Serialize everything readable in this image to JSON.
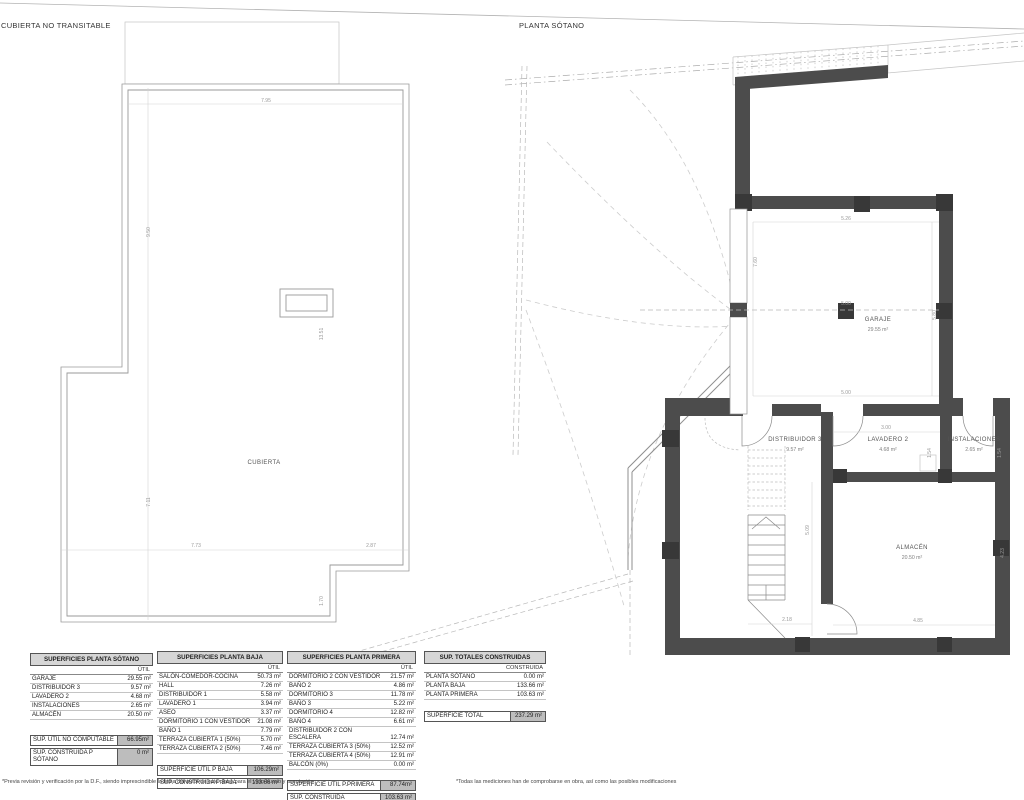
{
  "left_plan": {
    "title": "CUBIERTA NO TRANSITABLE",
    "room": "CUBIERTA",
    "dim_top": "7.95",
    "dim_left_upper": "9.50",
    "dim_left_lower": "7.11",
    "dim_skylight": "13.51",
    "dim_bottom_left": "7.73",
    "dim_bottom_right": "2.87",
    "dim_notch": "1.70"
  },
  "right_plan": {
    "title": "PLANTA SÓTANO",
    "rooms": {
      "garaje": {
        "name": "GARAJE",
        "area": "29.55 m²"
      },
      "distribuidor": {
        "name": "DISTRIBUIDOR 3",
        "area": "9.57 m²"
      },
      "lavadero": {
        "name": "LAVADERO 2",
        "area": "4.68 m²"
      },
      "instalaciones": {
        "name": "INSTALACIONES",
        "area": "2.65 m²"
      },
      "almacen": {
        "name": "ALMACÉN",
        "area": "20.50 m²"
      }
    },
    "dims": {
      "garage_w": "5.26",
      "garage_mid": "5.00",
      "garage_b": "5.00",
      "garage_left": "7.60",
      "garage_right": "5.80",
      "lav_w": "3.00",
      "lav_h": "1.54",
      "inst_h": "1.54",
      "stair_h": "5.09",
      "alm_w": "4.85",
      "alm_h": "4.23",
      "stair_w": "2.18"
    }
  },
  "tables": [
    {
      "title": "SUPERFICIES PLANTA SÓTANO",
      "col": "ÚTIL",
      "rows": [
        {
          "label": "GARAJE",
          "value": "29.55 m²"
        },
        {
          "label": "DISTRIBUIDOR 3",
          "value": "9.57 m²"
        },
        {
          "label": "LAVADERO 2",
          "value": "4.68 m²"
        },
        {
          "label": "INSTALACIONES",
          "value": "2.65 m²"
        },
        {
          "label": "ALMACÉN",
          "value": "20.50 m²"
        }
      ],
      "totals": [
        {
          "label": "SUP. ÚTIL NO COMPUTABLE",
          "value": "66.95m²"
        },
        {
          "label": "SUP. CONSTRUIDA P SÓTANO",
          "value": "0 m²"
        }
      ]
    },
    {
      "title": "SUPERFICIES PLANTA BAJA",
      "col": "ÚTIL",
      "rows": [
        {
          "label": "SALÓN-COMEDOR-COCINA",
          "value": "50.73 m²"
        },
        {
          "label": "HALL",
          "value": "7.26 m²"
        },
        {
          "label": "DISTRIBUIDOR 1",
          "value": "5.58 m²"
        },
        {
          "label": "LAVADERO 1",
          "value": "3.94 m²"
        },
        {
          "label": "ASEO",
          "value": "3.37 m²"
        },
        {
          "label": "DORMITORIO 1 CON VESTIDOR",
          "value": "21.08 m²"
        },
        {
          "label": "BAÑO 1",
          "value": "7.79 m²"
        },
        {
          "label": "TERRAZA CUBIERTA 1 (50%)",
          "value": "5.70 m²"
        },
        {
          "label": "TERRAZA CUBIERTA 2 (50%)",
          "value": "7.46 m²"
        }
      ],
      "totals": [
        {
          "label": "SUPERFICIE ÚTIL P BAJA",
          "value": "106.29m²"
        },
        {
          "label": "SUP. CONSTRUIDA P BAJA",
          "value": "133.66 m²"
        }
      ]
    },
    {
      "title": "SUPERFICIES PLANTA PRIMERA",
      "col": "ÚTIL",
      "rows": [
        {
          "label": "DORMITORIO 2 CON VESTIDOR",
          "value": "21.57 m²"
        },
        {
          "label": "BAÑO 2",
          "value": "4.86 m²"
        },
        {
          "label": "DORMITORIO 3",
          "value": "11.78 m²"
        },
        {
          "label": "BAÑO 3",
          "value": "5.22 m²"
        },
        {
          "label": "DORMITORIO 4",
          "value": "12.82 m²"
        },
        {
          "label": "BAÑO 4",
          "value": "6.61 m²"
        },
        {
          "label": "DISTRIBUIDOR 2 CON ESCALERA",
          "value": "12.74 m²"
        },
        {
          "label": "TERRAZA CUBIERTA 3 (50%)",
          "value": "12.52 m²"
        },
        {
          "label": "TERRAZA CUBIERTA 4 (50%)",
          "value": "12.91 m²"
        },
        {
          "label": "BALCÓN (0%)",
          "value": "0.00 m²"
        }
      ],
      "totals": [
        {
          "label": "SUPERFICIE ÚTIL P.PRIMERA",
          "value": "87.74m²"
        },
        {
          "label": "SUP. CONSTRUIDA P.PRIMERA",
          "value": "103.63 m²"
        }
      ]
    },
    {
      "title": "SUP. TOTALES CONSTRUIDAS",
      "col": "CONSTRUIDA",
      "rows": [
        {
          "label": "PLANTA SÓTANO",
          "value": "0.00 m²"
        },
        {
          "label": "PLANTA BAJA",
          "value": "133.66 m²"
        },
        {
          "label": "PLANTA PRIMERA",
          "value": "103.63 m²"
        }
      ],
      "totals": [
        {
          "label": "SUPERFICIE TOTAL",
          "value": "237.29 m²"
        }
      ]
    }
  ],
  "footnotes": {
    "left": "*Previa revisión y verificación por la D.F., siendo imprescindible la firma del autor de este plano para el visto bueno y aceptación",
    "right": "*Todas las mediciones han de comprobarse en obra, así como las posibles modificaciones"
  }
}
